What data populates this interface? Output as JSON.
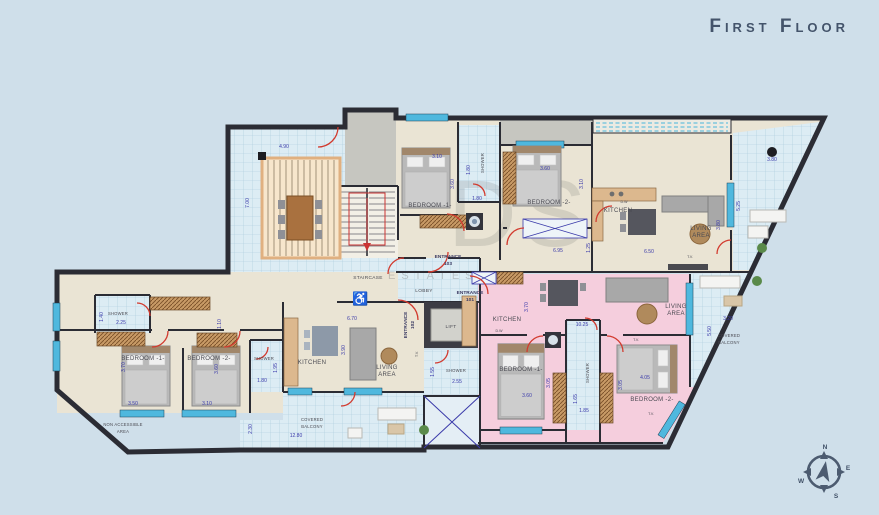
{
  "title": "First Floor",
  "watermark": {
    "line1": "DS",
    "line2": "ESTATES"
  },
  "icons": {
    "wheelchair": "♿"
  },
  "compass": {
    "n": "N",
    "e": "E",
    "s": "S",
    "w": "W"
  },
  "terrace": {
    "width": "4.90",
    "depth": "7.00"
  },
  "core": {
    "staircase": "STAIRCASE",
    "lobby": "LOBBY",
    "lift": "LIFT",
    "shower": "SHOWER",
    "shower_width": "2.55",
    "shower_depth": "1.55"
  },
  "flat103": {
    "entrance_label": "ENTRANCE",
    "entrance_number": "103",
    "bedroom1": "BEDROOM -1-",
    "bedroom2": "BEDROOM -2-",
    "kitchen": "KITCHEN",
    "dw": "D.W",
    "living_line1": "LIVING",
    "living_line2": "AREA",
    "shower": "SHOWER",
    "tv": "T.V.",
    "dims": {
      "bedroom1_width": "3.10",
      "bedroom1_depth": "3.60",
      "shower_depth": "1.80",
      "hall_width": "1.80",
      "bedroom2_width": "3.60",
      "bedroom2_depth": "3.10",
      "hall_length": "6.95",
      "living_width": "6.50",
      "living_depth": "3.80",
      "duct": "1.25"
    }
  },
  "balcony_top_right": {
    "width": "3.80",
    "depth": "5.25"
  },
  "balcony_right": {
    "line1": "COVERED",
    "line2": "BALCONY",
    "width": "3.20",
    "depth": "5.50"
  },
  "flat101": {
    "entrance_label": "ENTRANCE",
    "entrance_number": "101",
    "kitchen": "KITCHEN",
    "dw": "D.W",
    "living_line1": "LIVING",
    "living_line2": "AREA",
    "bedroom1": "BEDROOM -1-",
    "bedroom2": "BEDROOM -2-",
    "shower": "SHOWER",
    "tv_living": "T.V.",
    "tv_bedroom2": "T.V.",
    "dims": {
      "kitchen_depth": "3.70",
      "living_width": "10.25",
      "bedroom1_width": "3.60",
      "bedroom1_depth": "3.05",
      "bedroom2_width": "4.05",
      "bedroom2_depth": "3.05",
      "shower_width": "1.85",
      "shower_depth": "1.65"
    }
  },
  "flat102": {
    "entrance_label": "ENTRANCE",
    "entrance_number": "102",
    "shower1": "SHOWER",
    "shower2": "SHOWER",
    "bedroom1": "BEDROOM -1-",
    "bedroom2": "BEDROOM -2-",
    "kitchen": "KITCHEN",
    "living_line1": "LIVING",
    "living_line2": "AREA",
    "tv": "T.V.",
    "dims": {
      "shower1_width": "2.25",
      "shower1_depth": "1.40",
      "bedroom1_width": "3.50",
      "bedroom1_depth": "3.70",
      "bedroom2_width": "3.10",
      "bedroom2_depth": "3.60",
      "shower2_width": "1.80",
      "shower2_depth": "1.95",
      "hall_depth": "1.10",
      "living_width": "6.70",
      "living_depth": "3.90"
    }
  },
  "balcony_bottom": {
    "line1": "COVERED",
    "line2": "BALCONY",
    "width": "12.80",
    "depth": "2.30"
  },
  "outside": {
    "line1": "NON ACCESSIBLE",
    "line2": "AREA"
  },
  "colors": {
    "accent_red": "#d23a2e",
    "dim_blue": "#3a3aaa",
    "window_cyan": "#4fb8de",
    "pink": "#f5cedd",
    "cream": "#eae4d4"
  }
}
